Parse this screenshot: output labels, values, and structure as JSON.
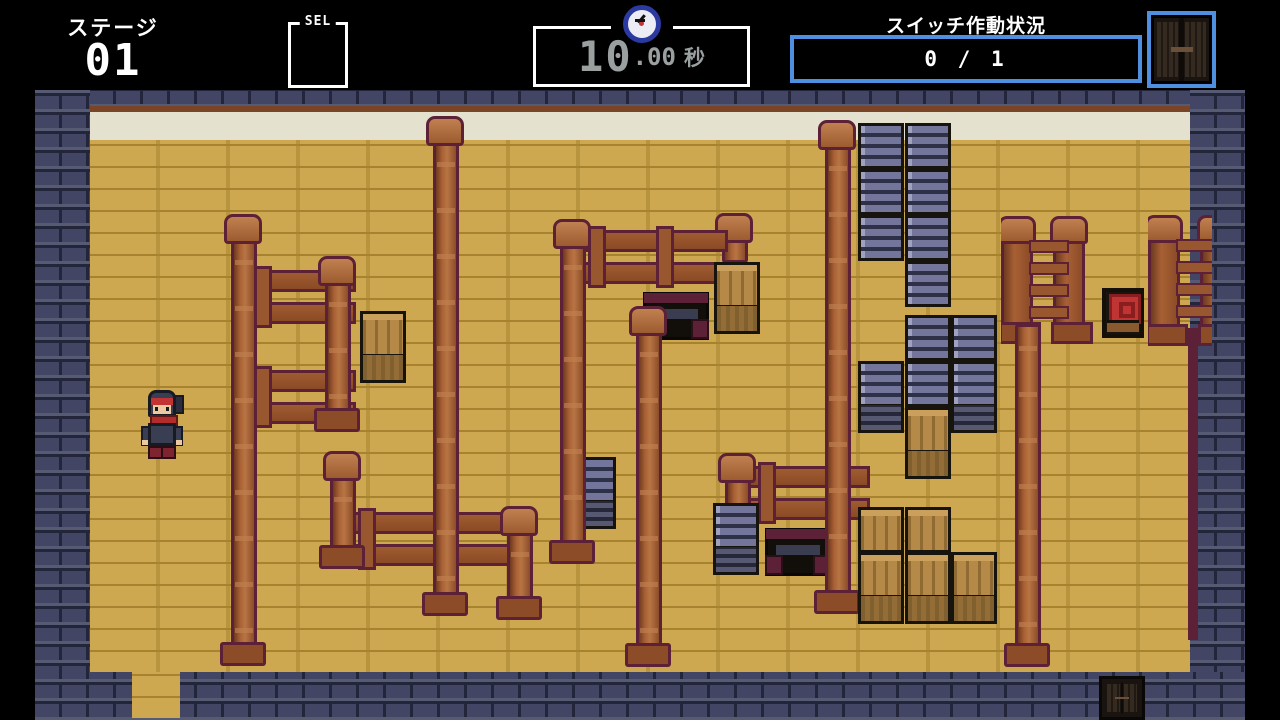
{
  "hud": {
    "stage_label": "ステージ",
    "stage_number": "01",
    "sel_label": "SEL",
    "timer": {
      "icon": "clock-icon",
      "seconds_main": "10",
      "seconds_frac": ".00",
      "unit_label": "秒"
    },
    "switch_panel": {
      "title": "スイッチ作動状況",
      "count": "0 / 1",
      "icon": "closed-double-door-icon"
    }
  },
  "colors": {
    "hud_accent_blue": "#4e8fe0",
    "hud_text": "#ffffff",
    "timer_text": "#9aa0a0",
    "floor_tan": "#cda851",
    "wall_navy": "#424563",
    "cream_band": "#e4e1cf",
    "post_brown": "#a86034",
    "post_outline_maroon": "#5c2136",
    "crate_wood": "#b58a49",
    "crate_metal": "#73759a",
    "switch_red": "#c13434"
  },
  "map": {
    "entities": [
      {
        "type": "wood-post",
        "x": 224,
        "y": 214,
        "h": 452,
        "cap": true,
        "base": true
      },
      {
        "type": "wood-post",
        "x": 426,
        "y": 116,
        "h": 500,
        "cap": true,
        "base": true
      },
      {
        "type": "wood-post",
        "x": 629,
        "y": 306,
        "h": 361,
        "cap": true,
        "base": true
      },
      {
        "type": "wood-post",
        "x": 818,
        "y": 120,
        "h": 494,
        "cap": true,
        "base": true
      },
      {
        "type": "wood-post",
        "x": 1008,
        "y": 322,
        "h": 345,
        "cap": false,
        "base": true
      },
      {
        "type": "wood-post",
        "x": 318,
        "y": 256,
        "h": 176,
        "cap": true,
        "base": true
      },
      {
        "type": "rail-h",
        "x": 244,
        "y": 270,
        "w": 112
      },
      {
        "type": "rail-h",
        "x": 244,
        "y": 370,
        "w": 112
      },
      {
        "type": "wood-post",
        "x": 323,
        "y": 451,
        "h": 118,
        "cap": true,
        "base": true
      },
      {
        "type": "rail-h",
        "x": 348,
        "y": 512,
        "w": 168
      },
      {
        "type": "wood-post",
        "x": 500,
        "y": 506,
        "h": 114,
        "cap": true,
        "base": true
      },
      {
        "type": "wood-post",
        "x": 553,
        "y": 219,
        "h": 345,
        "cap": true,
        "base": true
      },
      {
        "type": "rail-h",
        "x": 578,
        "y": 230,
        "w": 150
      },
      {
        "type": "wood-post",
        "x": 715,
        "y": 213,
        "h": 52,
        "cap": true,
        "base": false
      },
      {
        "type": "crate-brown",
        "x": 714,
        "y": 262,
        "face": true
      },
      {
        "type": "cart",
        "x": 643,
        "y": 292
      },
      {
        "type": "crate-gray",
        "x": 570,
        "y": 457,
        "face": true
      },
      {
        "type": "crate-gray",
        "x": 713,
        "y": 503,
        "face": true
      },
      {
        "type": "crate-brown",
        "x": 360,
        "y": 311,
        "face": true
      },
      {
        "type": "wood-post",
        "x": 718,
        "y": 453,
        "h": 72,
        "cap": true,
        "base": false
      },
      {
        "type": "rail-h",
        "x": 748,
        "y": 466,
        "w": 122
      },
      {
        "type": "cart",
        "x": 765,
        "y": 528
      },
      {
        "type": "post-pair",
        "x": 1001,
        "y": 216,
        "h": 114
      },
      {
        "type": "post-pair",
        "x": 1148,
        "y": 215,
        "h": 117,
        "clipw": 64
      },
      {
        "type": "edge-strip",
        "x": 1188,
        "y": 328,
        "h": 312
      },
      {
        "type": "switch",
        "x": 1102,
        "y": 288
      },
      {
        "type": "crate-gray",
        "x": 858,
        "y": 123
      },
      {
        "type": "crate-gray",
        "x": 858,
        "y": 169
      },
      {
        "type": "crate-gray",
        "x": 858,
        "y": 215
      },
      {
        "type": "crate-gray",
        "x": 905,
        "y": 123
      },
      {
        "type": "crate-gray",
        "x": 905,
        "y": 169
      },
      {
        "type": "crate-gray",
        "x": 905,
        "y": 215
      },
      {
        "type": "crate-gray",
        "x": 905,
        "y": 261
      },
      {
        "type": "crate-gray",
        "x": 905,
        "y": 315
      },
      {
        "type": "crate-gray",
        "x": 951,
        "y": 315
      },
      {
        "type": "crate-gray",
        "x": 858,
        "y": 361,
        "face": true
      },
      {
        "type": "crate-gray",
        "x": 905,
        "y": 361
      },
      {
        "type": "crate-gray",
        "x": 951,
        "y": 361,
        "face": true
      },
      {
        "type": "crate-brown",
        "x": 905,
        "y": 407,
        "face": true
      },
      {
        "type": "crate-brown",
        "x": 858,
        "y": 507
      },
      {
        "type": "crate-brown",
        "x": 905,
        "y": 507
      },
      {
        "type": "crate-brown",
        "x": 858,
        "y": 552,
        "face": true
      },
      {
        "type": "crate-brown",
        "x": 905,
        "y": 552,
        "face": true
      },
      {
        "type": "crate-brown",
        "x": 951,
        "y": 552,
        "face": true
      },
      {
        "type": "ninja",
        "x": 141,
        "y": 390
      },
      {
        "type": "door",
        "x": 1099,
        "y": 676
      },
      {
        "type": "floor-gap",
        "x": 132,
        "y": 672
      }
    ]
  }
}
